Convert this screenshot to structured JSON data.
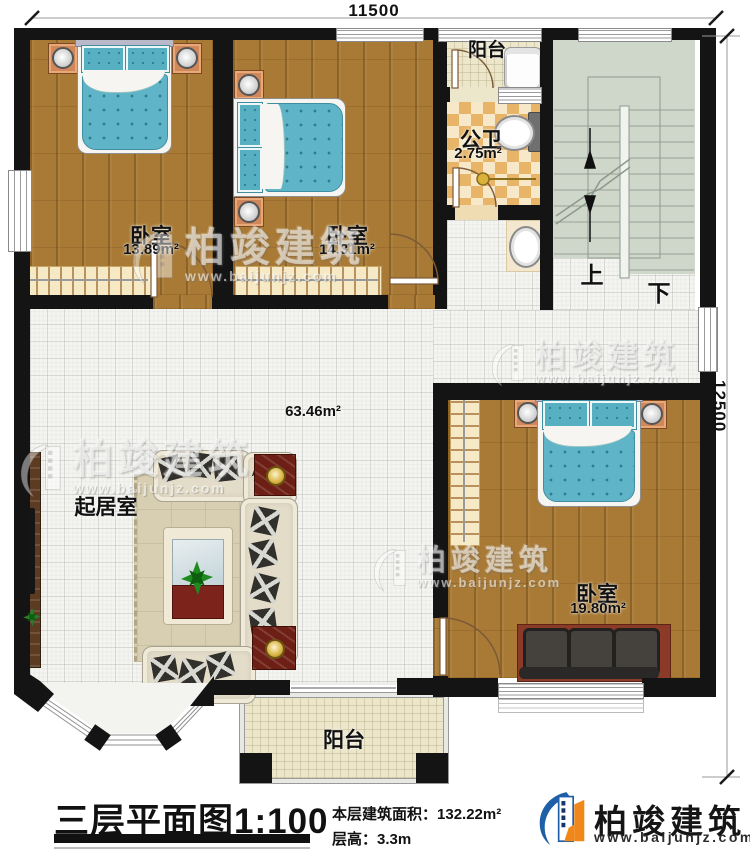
{
  "dimensions": {
    "top": "11500",
    "right": "12500"
  },
  "labels": {
    "bedroom1_name": "卧室",
    "bedroom1_area": "13.89m²",
    "bedroom2_name": "卧室",
    "bedroom2_area": "14.31m²",
    "bathroom_name": "公卫",
    "bathroom_area": "2.75m²",
    "balcony_top": "阳台",
    "living_name": "起居室",
    "living_area": "63.46m²",
    "bedroom3_name": "卧室",
    "bedroom3_area": "19.80m²",
    "balcony_bottom": "阳台",
    "stair_up": "上",
    "stair_down": "下"
  },
  "titleblock": {
    "title": "三层平面图1:100",
    "area_label": "本层建筑面积：",
    "area_value": "132.22m²",
    "height_label": "层高：",
    "height_value": "3.3m"
  },
  "brand": {
    "name": "柏竣建筑",
    "site": "www.baijunjz.com"
  },
  "watermark": {
    "name": "柏竣建筑",
    "site": "www.baijunjz.com"
  },
  "colors": {
    "accent_blue": "#1e5fa8",
    "accent_orange": "#f0871a",
    "wall": "#141414",
    "mattress": "#5fb5c7"
  }
}
